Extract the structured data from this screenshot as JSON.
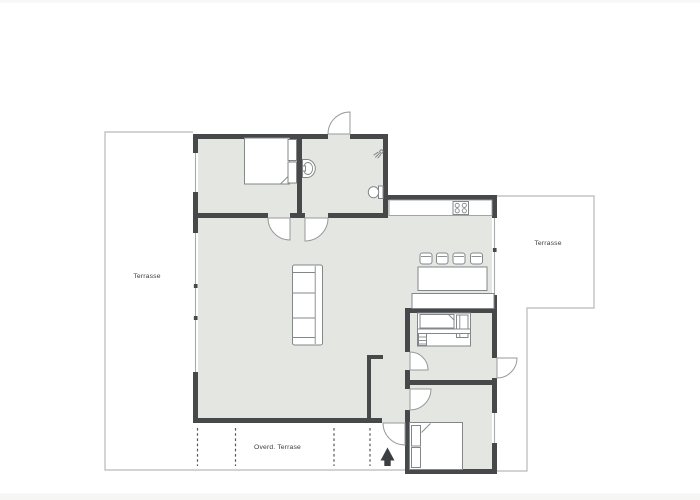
{
  "plan": {
    "labels": {
      "terrace_left": "Terrasse",
      "terrace_right": "Terrasse",
      "covered_terrace": "Overd. Terrase"
    },
    "icons": {
      "north_arrow": "north-arrow (solid black up-arrow marking entrance direction)",
      "shower": "shower-head spray glyph",
      "stove": "four-burner cooktop"
    },
    "colors": {
      "wall": "#46484a",
      "floor": "#e4e6e1",
      "stroke": "#84878a",
      "arc": "#97999b",
      "outline": "#b8babb",
      "winline": "#a8abad",
      "dash": "#54575a",
      "text": "#3b3d3e",
      "arrow": "#3c3f41",
      "page_edge": "#f6f6f5"
    }
  }
}
